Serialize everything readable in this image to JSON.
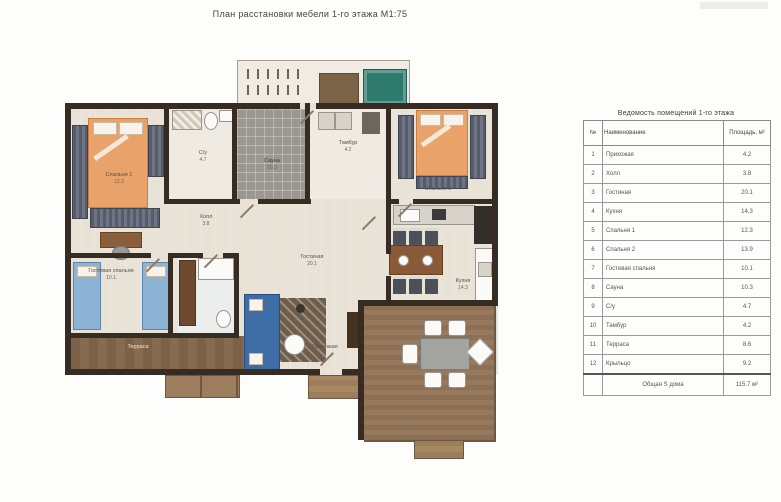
{
  "page": {
    "title": "План расстановки мебели 1-го этажа М1:75"
  },
  "plan_labels": {
    "bedroom1": {
      "name": "Спальня 1",
      "area": "12.3"
    },
    "bedroom2": {
      "name": "Спальня 2",
      "area": "13.9"
    },
    "guest_bedroom": {
      "name": "Гостевая спальня",
      "area": "10.1"
    },
    "living": {
      "name": "Гостиная",
      "area": "20.1"
    },
    "kitchen": {
      "name": "Кухня",
      "area": "14.3"
    },
    "hall": {
      "name": "Холл",
      "area": "3.8"
    },
    "sauna": {
      "name": "Сауна",
      "area": "10.3"
    },
    "wc": {
      "name": "С/у",
      "area": "4.7"
    },
    "tambour": {
      "name": "Тамбур",
      "area": "4.2"
    },
    "terrace": {
      "name": "Терраса",
      "area": "8.6"
    },
    "entry": {
      "name": "Прихожая",
      "area": "4.2"
    }
  },
  "legend": {
    "title": "Ведомость помещений 1-го этажа",
    "columns": [
      "№",
      "Наименование",
      "Площадь, м²"
    ],
    "rows": [
      [
        "1",
        "Прихожая",
        "4.2"
      ],
      [
        "2",
        "Холл",
        "3.8"
      ],
      [
        "3",
        "Гостиная",
        "20.1"
      ],
      [
        "4",
        "Кухня",
        "14.3"
      ],
      [
        "5",
        "Спальня 1",
        "12.3"
      ],
      [
        "6",
        "Спальня 2",
        "13.9"
      ],
      [
        "7",
        "Гостевая спальня",
        "10.1"
      ],
      [
        "8",
        "Сауна",
        "10.3"
      ],
      [
        "9",
        "С/у",
        "4.7"
      ],
      [
        "10",
        "Тамбур",
        "4.2"
      ],
      [
        "11",
        "Терраса",
        "8.6"
      ],
      [
        "12",
        "Крыльцо",
        "9.2"
      ]
    ],
    "total_label": "Общая S дома",
    "total_value": "115.7 м²"
  },
  "colors": {
    "wall": "#362c24",
    "floor": "#e8e2d7",
    "bed_orange": "#e9a269",
    "sofa_blue": "#3e6da6",
    "guest_bed_blue": "#8db4d4",
    "sauna_tile": "#9b9791",
    "deck_wood": "#8d7054",
    "hot_tub_teal": "#2e7a6d",
    "table_border": "#6a6a6a"
  }
}
